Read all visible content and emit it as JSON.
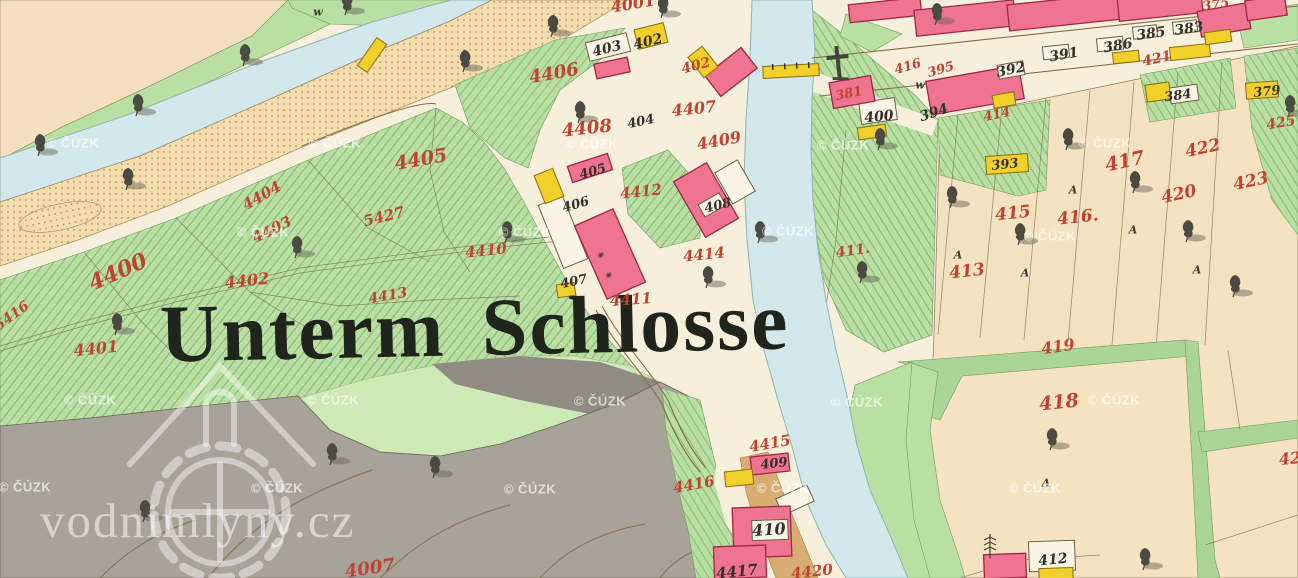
{
  "map": {
    "title": "Unterm Schlosse",
    "site_watermark": "vodnimlyny.cz",
    "watermark": {
      "text": "© ČÚZK",
      "positions": [
        [
          73,
          143
        ],
        [
          335,
          143
        ],
        [
          592,
          144
        ],
        [
          843,
          145
        ],
        [
          1105,
          143
        ],
        [
          263,
          232
        ],
        [
          525,
          232
        ],
        [
          788,
          231
        ],
        [
          1050,
          236
        ],
        [
          90,
          400
        ],
        [
          333,
          400
        ],
        [
          600,
          401
        ],
        [
          857,
          402
        ],
        [
          1114,
          400
        ],
        [
          25,
          487
        ],
        [
          277,
          488
        ],
        [
          530,
          489
        ],
        [
          783,
          488
        ],
        [
          1035,
          488
        ]
      ]
    },
    "colors": {
      "paper": "#f4eeda",
      "field_beige": "#f5e2c0",
      "field_peach": "#f6dfbe",
      "meadow_green": "#b9dfa3",
      "light_green": "#cfe9b6",
      "water": "#d3e8ea",
      "sand": "#f3dcae",
      "hill_gray": "#a8a399",
      "building_pink": "#ee7490",
      "building_yellow": "#f2d02c",
      "parcel_red": "#bf4430",
      "ink_black": "#33312a"
    },
    "parcel_labels_red": [
      {
        "text": "4001",
        "x": 633,
        "y": 4,
        "rot": -10,
        "size": 16
      },
      {
        "text": "402",
        "x": 696,
        "y": 66,
        "rot": -15,
        "size": 14
      },
      {
        "text": "4406",
        "x": 554,
        "y": 74,
        "rot": -10,
        "size": 18
      },
      {
        "text": "4407",
        "x": 694,
        "y": 109,
        "rot": -6,
        "size": 16
      },
      {
        "text": "4408",
        "x": 587,
        "y": 129,
        "rot": -6,
        "size": 18
      },
      {
        "text": "4409",
        "x": 719,
        "y": 141,
        "rot": -10,
        "size": 16
      },
      {
        "text": "4405",
        "x": 421,
        "y": 160,
        "rot": -10,
        "size": 19
      },
      {
        "text": "4412",
        "x": 641,
        "y": 192,
        "rot": -6,
        "size": 15
      },
      {
        "text": "4410",
        "x": 486,
        "y": 251,
        "rot": -6,
        "size": 15
      },
      {
        "text": "4414",
        "x": 704,
        "y": 255,
        "rot": -6,
        "size": 15
      },
      {
        "text": "4411",
        "x": 631,
        "y": 300,
        "rot": -4,
        "size": 15
      },
      {
        "text": "4404",
        "x": 262,
        "y": 196,
        "rot": -30,
        "size": 15
      },
      {
        "text": "4403",
        "x": 272,
        "y": 230,
        "rot": -26,
        "size": 15
      },
      {
        "text": "5427",
        "x": 384,
        "y": 217,
        "rot": -14,
        "size": 15
      },
      {
        "text": "4400",
        "x": 118,
        "y": 272,
        "rot": -24,
        "size": 22
      },
      {
        "text": "5416",
        "x": 12,
        "y": 316,
        "rot": -36,
        "size": 14
      },
      {
        "text": "4402",
        "x": 247,
        "y": 281,
        "rot": -6,
        "size": 16
      },
      {
        "text": "4413",
        "x": 388,
        "y": 296,
        "rot": -10,
        "size": 14
      },
      {
        "text": "4401",
        "x": 96,
        "y": 349,
        "rot": -6,
        "size": 16
      },
      {
        "text": "411.",
        "x": 853,
        "y": 251,
        "rot": -8,
        "size": 14
      },
      {
        "text": "381",
        "x": 849,
        "y": 94,
        "rot": -12,
        "size": 13
      },
      {
        "text": "416",
        "x": 908,
        "y": 67,
        "rot": -16,
        "size": 13
      },
      {
        "text": "395",
        "x": 941,
        "y": 70,
        "rot": -16,
        "size": 13
      },
      {
        "text": "414",
        "x": 997,
        "y": 115,
        "rot": -12,
        "size": 13
      },
      {
        "text": "417",
        "x": 1125,
        "y": 162,
        "rot": -12,
        "size": 19
      },
      {
        "text": "422",
        "x": 1203,
        "y": 149,
        "rot": -12,
        "size": 17
      },
      {
        "text": "423",
        "x": 1251,
        "y": 182,
        "rot": -12,
        "size": 17
      },
      {
        "text": "420",
        "x": 1179,
        "y": 195,
        "rot": -12,
        "size": 17
      },
      {
        "text": "415",
        "x": 1013,
        "y": 214,
        "rot": -6,
        "size": 17
      },
      {
        "text": "416.",
        "x": 1078,
        "y": 218,
        "rot": -6,
        "size": 17
      },
      {
        "text": "413",
        "x": 967,
        "y": 272,
        "rot": -6,
        "size": 17
      },
      {
        "text": "421",
        "x": 1157,
        "y": 59,
        "rot": -12,
        "size": 14
      },
      {
        "text": "375",
        "x": 1216,
        "y": 5,
        "rot": -10,
        "size": 13
      },
      {
        "text": "425",
        "x": 1281,
        "y": 123,
        "rot": -10,
        "size": 14
      },
      {
        "text": "419",
        "x": 1058,
        "y": 347,
        "rot": -8,
        "size": 16
      },
      {
        "text": "418",
        "x": 1059,
        "y": 403,
        "rot": -6,
        "size": 19
      },
      {
        "text": "42",
        "x": 1290,
        "y": 459,
        "rot": -6,
        "size": 16
      },
      {
        "text": "4415",
        "x": 770,
        "y": 444,
        "rot": -10,
        "size": 15
      },
      {
        "text": "4416",
        "x": 694,
        "y": 485,
        "rot": -10,
        "size": 15
      },
      {
        "text": "4420",
        "x": 812,
        "y": 572,
        "rot": -6,
        "size": 15
      },
      {
        "text": "4007",
        "x": 370,
        "y": 569,
        "rot": -8,
        "size": 18
      }
    ],
    "building_labels_black": [
      {
        "text": "403",
        "x": 607,
        "y": 49,
        "rot": -14,
        "size": 14
      },
      {
        "text": "402",
        "x": 648,
        "y": 42,
        "rot": -14,
        "size": 14
      },
      {
        "text": "404",
        "x": 641,
        "y": 122,
        "rot": -12,
        "size": 13
      },
      {
        "text": "405",
        "x": 593,
        "y": 172,
        "rot": -16,
        "size": 13
      },
      {
        "text": "406",
        "x": 576,
        "y": 205,
        "rot": -16,
        "size": 13
      },
      {
        "text": "407",
        "x": 574,
        "y": 282,
        "rot": -12,
        "size": 13
      },
      {
        "text": "408",
        "x": 718,
        "y": 206,
        "rot": -14,
        "size": 13
      },
      {
        "text": "409",
        "x": 774,
        "y": 464,
        "rot": -6,
        "size": 13
      },
      {
        "text": "410",
        "x": 769,
        "y": 530,
        "rot": -4,
        "size": 16
      },
      {
        "text": "412",
        "x": 1053,
        "y": 560,
        "rot": -6,
        "size": 14
      },
      {
        "text": "400",
        "x": 879,
        "y": 117,
        "rot": -6,
        "size": 14
      },
      {
        "text": "394",
        "x": 934,
        "y": 113,
        "rot": -18,
        "size": 14
      },
      {
        "text": "392",
        "x": 1011,
        "y": 70,
        "rot": -12,
        "size": 14
      },
      {
        "text": "391",
        "x": 1064,
        "y": 55,
        "rot": -10,
        "size": 14
      },
      {
        "text": "386",
        "x": 1118,
        "y": 46,
        "rot": -10,
        "size": 14
      },
      {
        "text": "385",
        "x": 1151,
        "y": 34,
        "rot": -8,
        "size": 14
      },
      {
        "text": "383",
        "x": 1189,
        "y": 29,
        "rot": -8,
        "size": 14
      },
      {
        "text": "393",
        "x": 1005,
        "y": 165,
        "rot": -6,
        "size": 13
      },
      {
        "text": "384",
        "x": 1178,
        "y": 96,
        "rot": -8,
        "size": 13
      },
      {
        "text": "379",
        "x": 1267,
        "y": 92,
        "rot": -6,
        "size": 13
      },
      {
        "text": "4417",
        "x": 737,
        "y": 572,
        "rot": -6,
        "size": 15
      }
    ],
    "symbols": [
      {
        "text": "w",
        "x": 318,
        "y": 12,
        "rot": 0,
        "size": 11
      },
      {
        "text": "w",
        "x": 920,
        "y": 85,
        "rot": 0,
        "size": 11
      },
      {
        "text": "A",
        "x": 1073,
        "y": 190,
        "rot": 0,
        "size": 11
      },
      {
        "text": "A",
        "x": 1133,
        "y": 230,
        "rot": 0,
        "size": 11
      },
      {
        "text": "A",
        "x": 958,
        "y": 255,
        "rot": 0,
        "size": 11
      },
      {
        "text": "A",
        "x": 1025,
        "y": 273,
        "rot": 0,
        "size": 11
      },
      {
        "text": "A",
        "x": 1197,
        "y": 270,
        "rot": 0,
        "size": 11
      },
      {
        "text": "A",
        "x": 1046,
        "y": 483,
        "rot": 0,
        "size": 11
      },
      {
        "text": "✳",
        "x": 600,
        "y": 255,
        "rot": 0,
        "size": 8
      },
      {
        "text": "✳",
        "x": 608,
        "y": 275,
        "rot": 0,
        "size": 8
      }
    ]
  }
}
